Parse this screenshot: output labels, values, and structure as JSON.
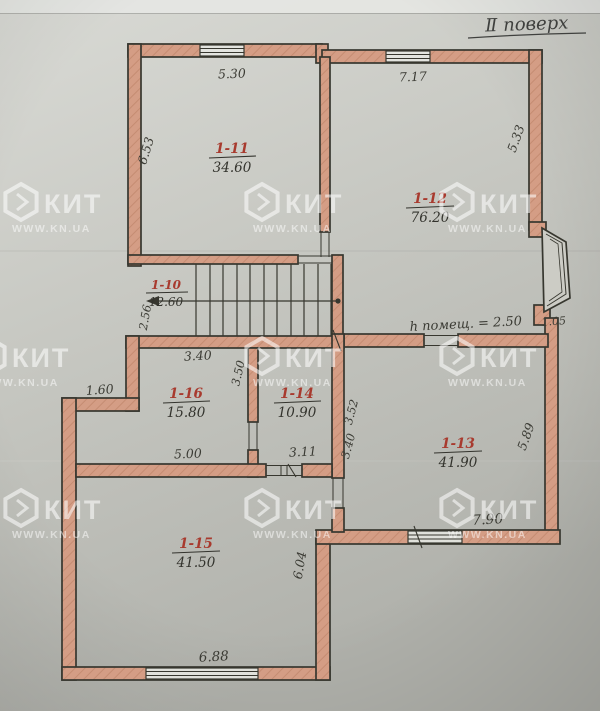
{
  "title": "Ⅱ поверх",
  "watermark": {
    "brand": "КИТ",
    "site": "WWW.KN.UA"
  },
  "rooms": [
    {
      "number": "1-11",
      "area": "34.60"
    },
    {
      "number": "1-12",
      "area": "76.20"
    },
    {
      "number": "1-10",
      "area": "12.60"
    },
    {
      "number": "1-16",
      "area": "15.80"
    },
    {
      "number": "1-14",
      "area": "10.90"
    },
    {
      "number": "1-13",
      "area": "41.90"
    },
    {
      "number": "1-15",
      "area": "41.50"
    }
  ],
  "dims": {
    "top_left": "5.30",
    "top_right": "7.17",
    "left_upper": "6.53",
    "right_upper": "5.33",
    "stair_left": "2.56",
    "room16_top": "3.40",
    "left_step": "1.60",
    "room16_right": "3.50",
    "room13_left_upper": "3.52",
    "room13_left_lower": "3.40",
    "room15_top_left": "5.00",
    "room15_top_right": "3.11",
    "right_lower": "5.89",
    "room13_bottom": "7.90",
    "room15_right": "6.04",
    "bottom": "6.88",
    "height_note": "h помещ. = 2.50",
    "bay_side": "1.05"
  },
  "colors": {
    "paper": "#c9cac4",
    "wall_fill": "#d39b84",
    "ink": "#3a3a34",
    "room_number_red": "#a83a2e",
    "watermark": "rgba(255,255,255,0.55)"
  }
}
